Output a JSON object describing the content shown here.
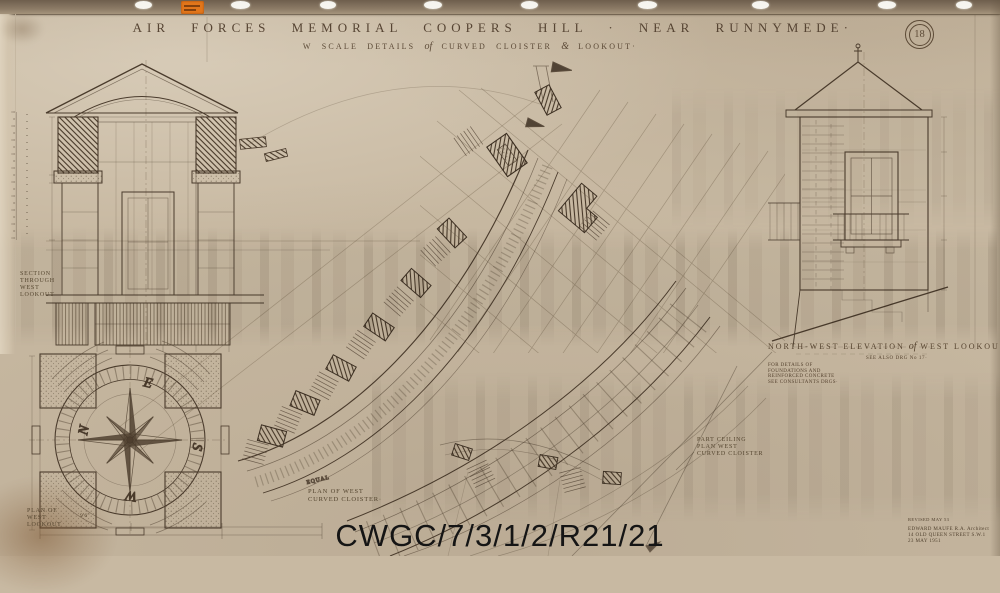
{
  "sheet": {
    "number": "18",
    "title": "AIR FORCES MEMORIAL COOPERS HILL · NEAR RUNNYMEDE·",
    "subtitle_prefix": "W SCALE DETAILS",
    "subtitle_of": "of",
    "subtitle_mid": "CURVED CLOISTER",
    "subtitle_amp": "&",
    "subtitle_end": "LOOKOUT·"
  },
  "watermark": "CWGC/7/3/1/2/R21/21",
  "labels": {
    "section_lookout": [
      "SECTION",
      "THROUGH",
      "WEST",
      "LOOKOUT"
    ],
    "plan_lookout": [
      "PLAN OF",
      "WEST",
      "LOOKOUT"
    ],
    "plan_cloister": [
      "PLAN OF WEST",
      "CURVED CLOISTER·"
    ],
    "ceiling_plan": [
      "PART CEILING",
      "PLAN WEST",
      "CURVED CLOISTER"
    ],
    "elevation_prefix": "NORTH-WEST ELEVATION",
    "elevation_of": "of",
    "elevation_rest": "WEST LOOKOUT",
    "elevation_ref": "SEE ALSO DRG No 17·",
    "elevation_note": [
      "FOR DETAILS OF",
      "FOUNDATIONS AND",
      "REINFORCED CONCRETE",
      "SEE CONSULTANTS DRGS·"
    ],
    "equal": "EQUAL"
  },
  "compass": {
    "east": "E",
    "south": "S",
    "west": "W",
    "north": "N"
  },
  "dimensions": {
    "plan_width": "9'6\""
  },
  "title_block": {
    "revision": "REVISED MAY 53",
    "architect": "EDWARD MAUFE R.A. Architect",
    "address": "14 OLD QUEEN STREET S.W.1",
    "date": "23 MAY 1951"
  },
  "colors": {
    "paper": "#c8b9a2",
    "ink": "#4a3b2c",
    "sticker": "#e2761b",
    "watermark": "#151515"
  }
}
